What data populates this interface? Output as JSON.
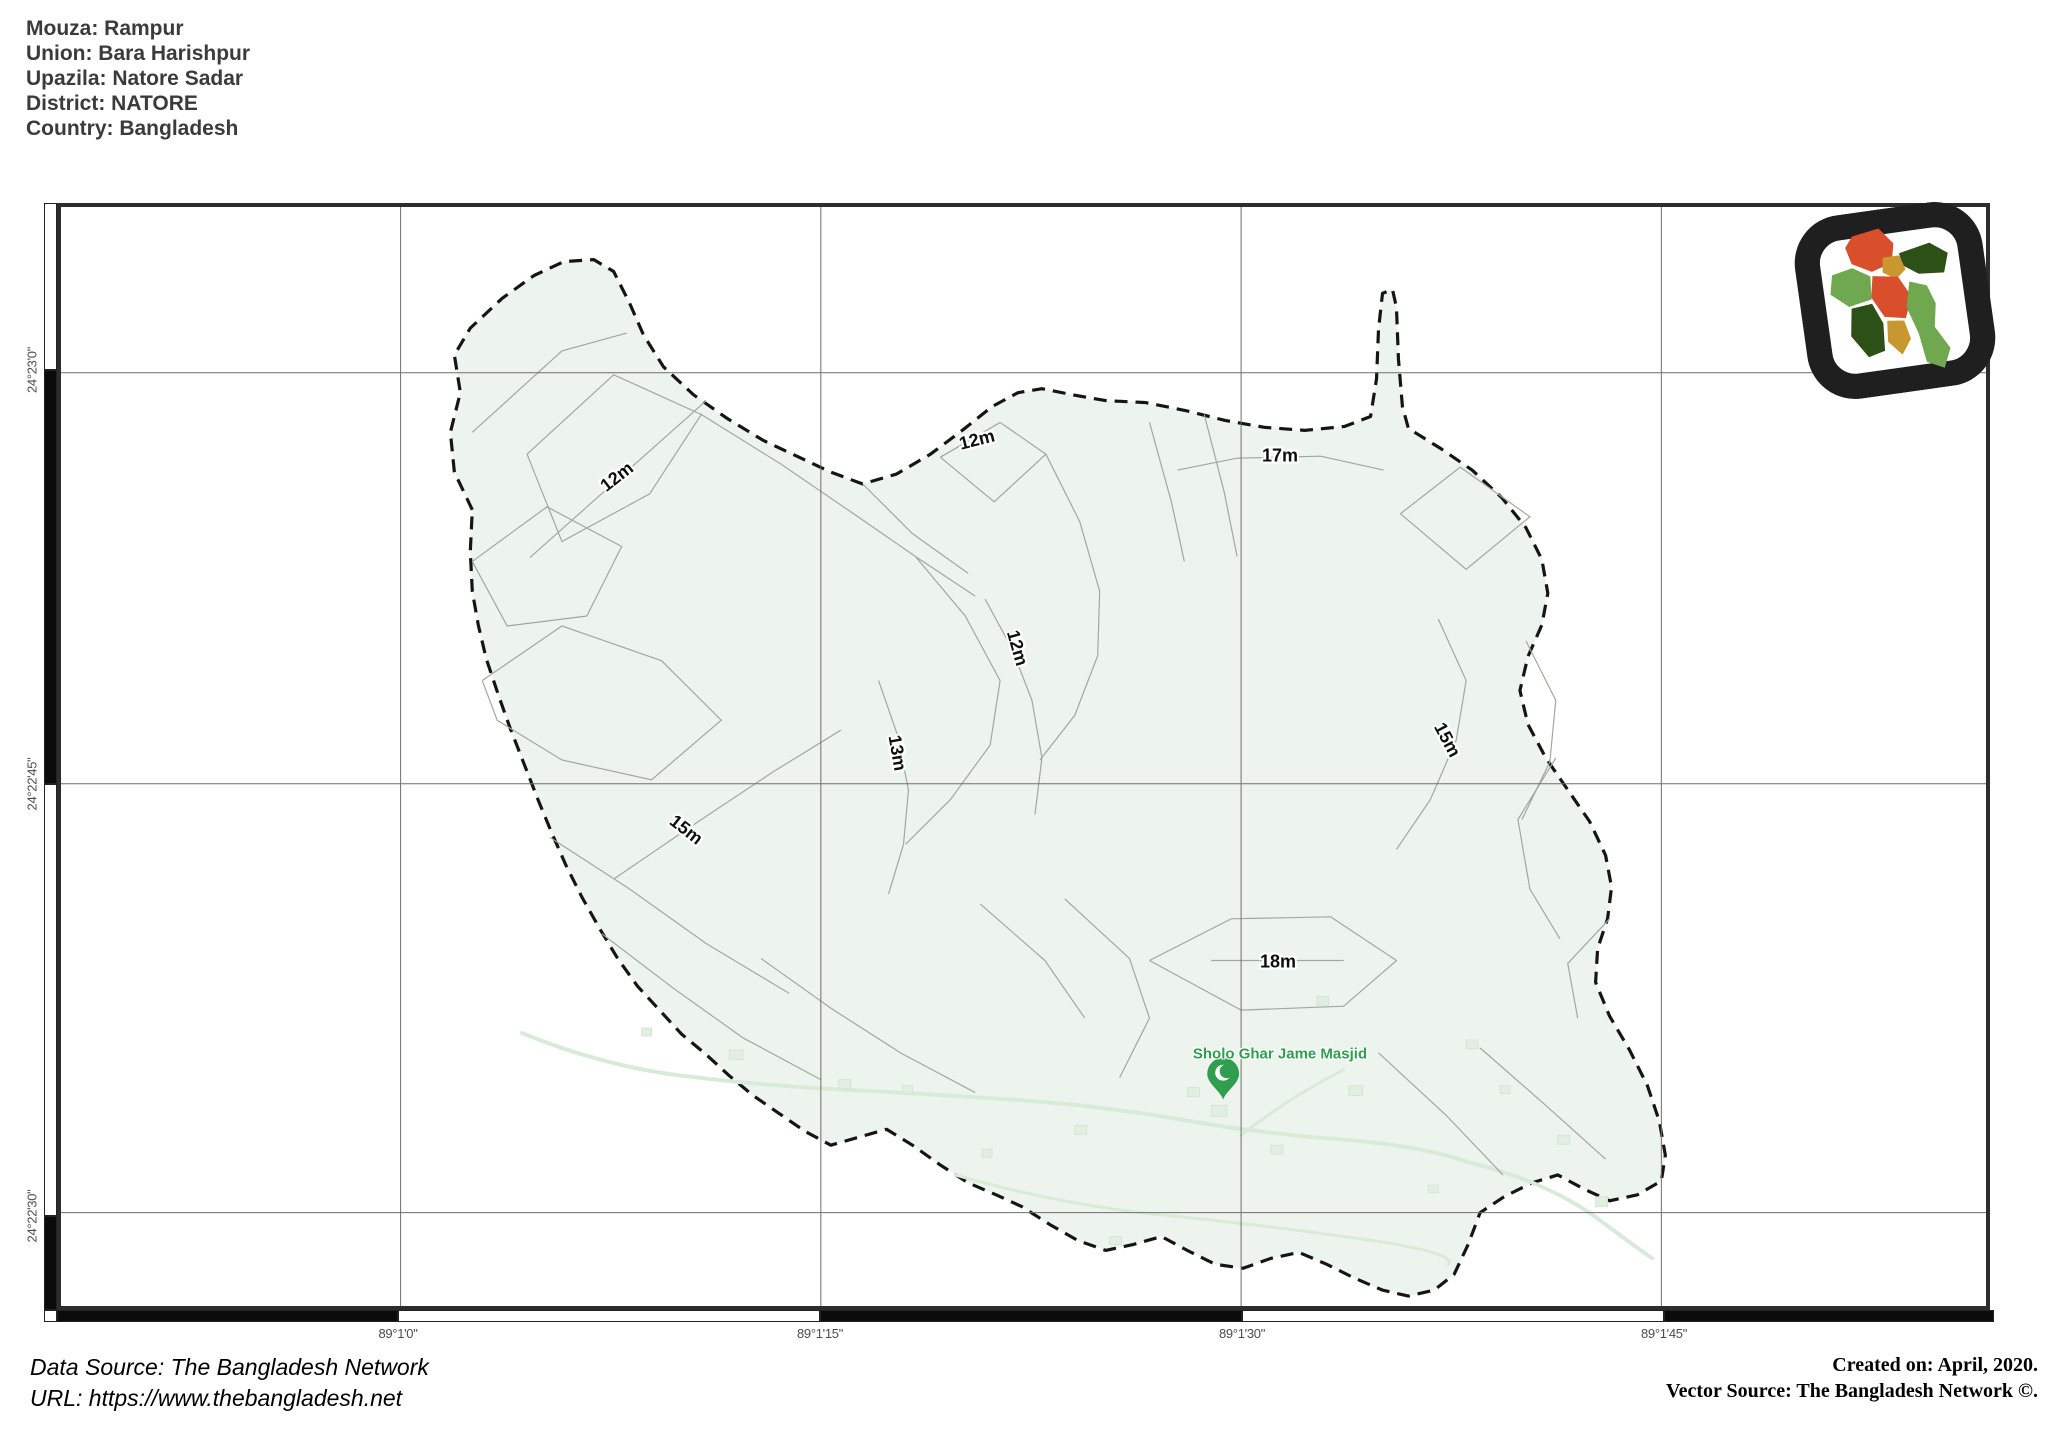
{
  "title_block": {
    "lines": [
      "Mouza: Rampur",
      "Union: Bara Harishpur",
      "Upazila: Natore Sadar",
      "District: NATORE",
      "Country: Bangladesh"
    ]
  },
  "map": {
    "latitude_labels": [
      "24°23'0\"",
      "24°22'45\"",
      "24°22'30\""
    ],
    "longitude_labels": [
      "89°1'0\"",
      "89°1'15\"",
      "89°1'30\"",
      "89°1'45\""
    ],
    "contour_labels": [
      "12m",
      "12m",
      "17m",
      "12m",
      "13m",
      "15m",
      "15m",
      "18m"
    ],
    "poi": {
      "label": "Sholo Ghar Jame Masjid",
      "icon": "mosque-pin-icon"
    },
    "logo": {
      "icon": "bangladesh-map-logo"
    }
  },
  "footer": {
    "source_lines": [
      "Data Source: The Bangladesh Network",
      "URL: https://www.thebangladesh.net"
    ],
    "credit_lines": [
      "Created on: April, 2020.",
      "Vector Source: The Bangladesh Network ©."
    ]
  },
  "colors": {
    "map_fill": "#ecf4ed",
    "boundary": "#151515",
    "contour": "#a0a8a0",
    "road": "#d8ebd8",
    "poi_green": "#2f9e4f",
    "logo_red": "#d94f2b",
    "logo_green": "#6fa84e",
    "logo_dark_green": "#2d5016",
    "logo_gold": "#c9972f"
  }
}
